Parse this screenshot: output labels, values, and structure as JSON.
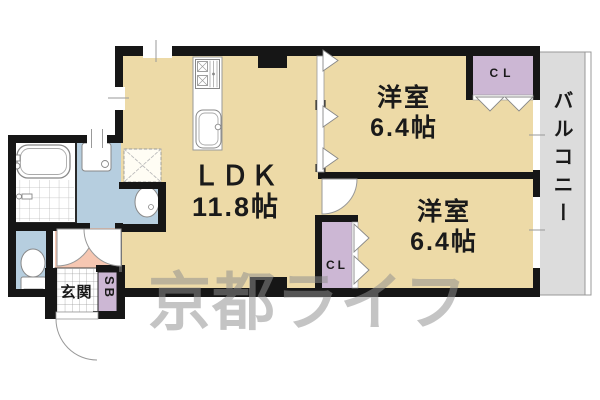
{
  "floorplan": {
    "rooms": {
      "ldk": {
        "name": "ＬＤＫ",
        "size": "11.8帖"
      },
      "bedroom1": {
        "name": "洋室",
        "size": "6.4帖"
      },
      "bedroom2": {
        "name": "洋室",
        "size": "6.4帖"
      },
      "balcony": {
        "name": "バルコニー"
      },
      "entrance": {
        "name": "玄関"
      },
      "closet1": {
        "label": "CL"
      },
      "closet2": {
        "label": "CL"
      },
      "shoebox": {
        "label": "SB"
      }
    },
    "watermark_text": "京都ライフ",
    "colors": {
      "room_fill": "#eddaa7",
      "wet_area_fill": "#b6cedf",
      "hall_fill": "#f6c7b2",
      "closet_fill": "#ccb7d4",
      "balcony_fill": "#dcdcdc",
      "wall": "#161616",
      "watermark": "#8f8f8f"
    }
  }
}
